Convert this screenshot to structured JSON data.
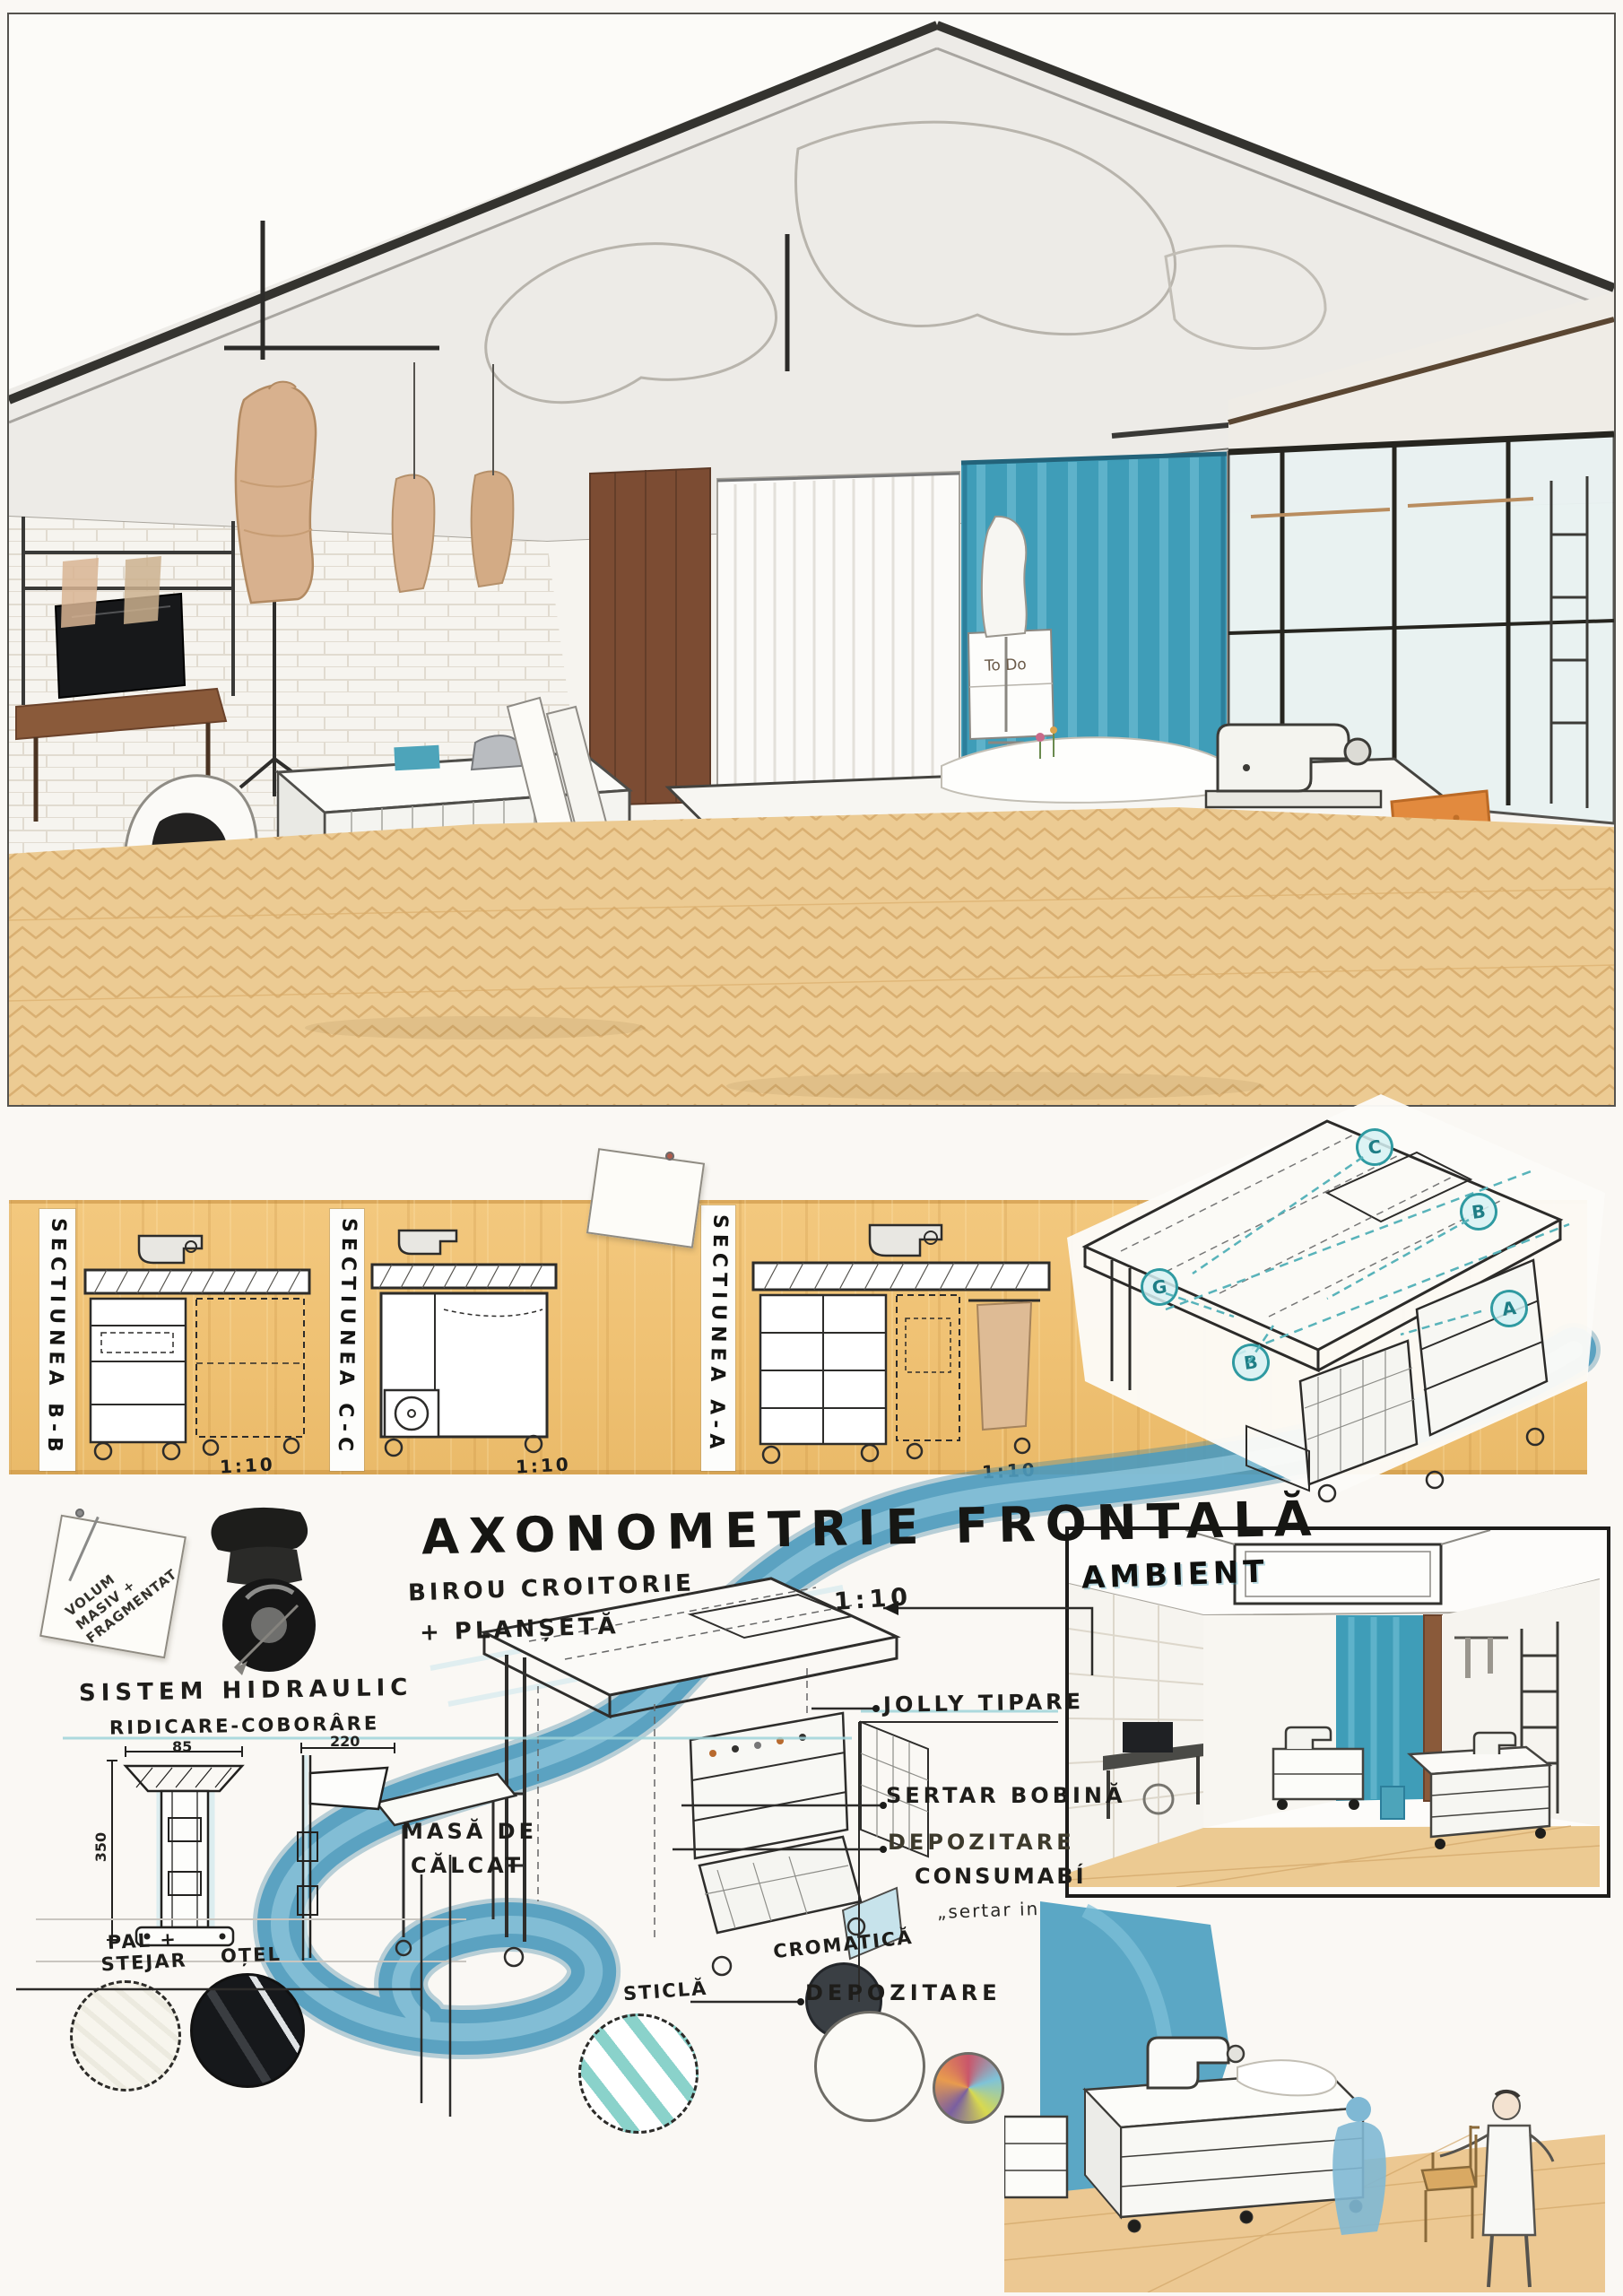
{
  "colors": {
    "paper": "#faf8f4",
    "wood_band": "#efc173",
    "floor_tan": "#eccb93",
    "watercolor_blue": "#4f9cbe",
    "teal_curtain": "#3f9db8",
    "teal_marker": "#2f9aa1",
    "ink": "#23221f",
    "door_brown": "#7c4c33",
    "chair_orange": "#e28a3e",
    "mannequin_tan": "#d8b18e"
  },
  "top": {
    "poster": "To Do"
  },
  "band": {
    "sections": [
      {
        "label": "SECTIUNEA B-B",
        "scale": "1:10"
      },
      {
        "label": "SECTIUNEA C-C",
        "scale": "1:10"
      },
      {
        "label": "SECTIUNEA A-A",
        "scale": "1:10"
      }
    ]
  },
  "axo": {
    "title": "AXONOMETRIE FRONTALĂ",
    "scale": "1:10",
    "markers": [
      "C",
      "B",
      "A",
      "G",
      "B"
    ]
  },
  "annotations": {
    "sticky": [
      "VOLUM",
      "MASIV +",
      "FRAGMENTAT"
    ],
    "sistem1": "SISTEM HIDRAULIC",
    "sistem2": "RIDICARE-COBORÂRE",
    "birou1": "BIROU CROITORIE",
    "birou2": "+ PLANȘETĂ",
    "masa1": "MASĂ DE",
    "masa2": "CĂLCAT",
    "jolly": "JOLLY TIPARE",
    "sertar": "SERTAR BOBINĂ",
    "dep1": "DEPOZITARE",
    "dep2": "CONSUMABÍ",
    "dep3": "„sertar in",
    "depozitare": "DEPOZITARE"
  },
  "details": {
    "w1": "85",
    "h1": "350",
    "w2": "220"
  },
  "materials": [
    "PAL + STEJAR",
    "OȚEL",
    "STICLĂ",
    "CROMATICĂ"
  ],
  "ambient": {
    "label": "AMBIENT"
  }
}
